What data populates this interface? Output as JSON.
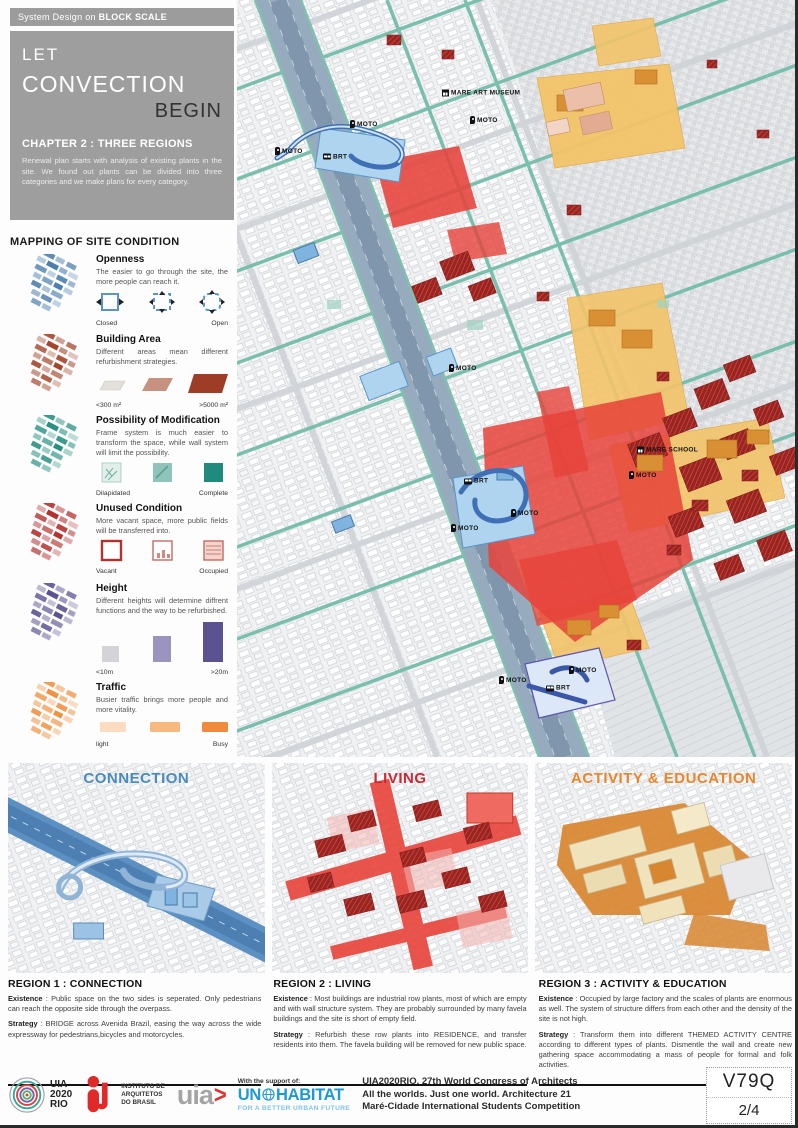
{
  "labels": {
    "separator": " : "
  },
  "header": {
    "kicker_normal": "System Design on",
    "kicker_bold": "BLOCK SCALE",
    "title_line1": "LET",
    "title_line2": "CONVECTION",
    "title_line3": "BEGIN",
    "chapter": "CHAPTER 2 : THREE REGIONS",
    "chapter_desc": "Renewal plan starts with analysis of existing plants in the site. We found out plants can be divided into three categories and we make plans for every category."
  },
  "legend": {
    "title": "MAPPING OF SITE CONDITION",
    "items": [
      {
        "name": "Openness",
        "desc": "The easier to go through the site, the more people can reach it.",
        "scale_left": "Closed",
        "scale_right": "Open",
        "color": "#4d7fae"
      },
      {
        "name": "Building Area",
        "desc": "Different areas mean different refurbishment strategies.",
        "scale_left": "<300 m²",
        "scale_right": ">5000 m²",
        "color": "#a3462c"
      },
      {
        "name": "Possibility of Modification",
        "desc": "Frame system is much easier to transform the space, while wall system will limit the possibility.",
        "scale_left": "Dilapidated",
        "scale_right": "Complete",
        "color": "#279183"
      },
      {
        "name": "Unused Condition",
        "desc": "More vacant space, more public fields will be transferred into.",
        "scale_left": "Vacant",
        "scale_right": "Occupied",
        "color": "#b23230"
      },
      {
        "name": "Height",
        "desc": "Different heights will determine diffrent functions and the way to be refurbished.",
        "scale_left": "<10m",
        "scale_right": ">20m",
        "color": "#5b5391"
      },
      {
        "name": "Traffic",
        "desc": "Busier traffic brings more people and more vitality.",
        "scale_left": "light",
        "scale_right": "Busy",
        "color": "#ef9242"
      }
    ]
  },
  "map": {
    "labels": [
      {
        "text": "MARE ART MUSEUM",
        "icon": "museum",
        "x": 205,
        "y": 93
      },
      {
        "text": "MOTO",
        "icon": "pin",
        "x": 233,
        "y": 120
      },
      {
        "text": "MOTO",
        "icon": "pin",
        "x": 113,
        "y": 124
      },
      {
        "text": "MOTO",
        "icon": "pin",
        "x": 38,
        "y": 151
      },
      {
        "text": "BRT",
        "icon": "bus",
        "x": 86,
        "y": 157
      },
      {
        "text": "MOTO",
        "icon": "pin",
        "x": 212,
        "y": 368
      },
      {
        "text": "MARE SCHOOL",
        "icon": "school",
        "x": 400,
        "y": 450
      },
      {
        "text": "MOTO",
        "icon": "pin",
        "x": 392,
        "y": 475
      },
      {
        "text": "BRT",
        "icon": "bus",
        "x": 227,
        "y": 481
      },
      {
        "text": "MOTO",
        "icon": "pin",
        "x": 274,
        "y": 513
      },
      {
        "text": "MOTO",
        "icon": "pin",
        "x": 214,
        "y": 528
      },
      {
        "text": "MOTO",
        "icon": "pin",
        "x": 332,
        "y": 670
      },
      {
        "text": "MOTO",
        "icon": "pin",
        "x": 262,
        "y": 680
      },
      {
        "text": "BRT",
        "icon": "bus",
        "x": 309,
        "y": 688
      }
    ]
  },
  "panels": [
    {
      "title": "CONNECTION",
      "accent": "#4a8bbf",
      "heading": "REGION 1 : CONNECTION",
      "existence_label": "Existence",
      "existence": "Public space on the two sides is seperated. Only pedestrians can reach the opposite side through the overpass.",
      "strategy_label": "Strategy",
      "strategy": "BRIDGE across Avenida Brazil, easing the way across the wide expressway for pedestrians,bicycles and motorcycles."
    },
    {
      "title": "LIVING",
      "accent": "#cc2a33",
      "heading": "REGION 2 : LIVING",
      "existence_label": "Existence",
      "existence": "Most buildings are industrial row plants, most of which are empty and with wall structure system. They are probably surrounded by many favela buildings and the site is short of empty field.",
      "strategy_label": "Strategy",
      "strategy": "Refurbish these row plants into RESIDENCE, and transfer residents into them. The favela building will be removed for new public space."
    },
    {
      "title": "ACTIVITY & EDUCATION",
      "accent": "#e8862e",
      "heading": "REGION 3 : ACTIVITY & EDUCATION",
      "existence_label": "Existence",
      "existence": "Occupied by large factory and the scales of plants are enormous as well. The system of structure differs from each other and the density of the site is not high.",
      "strategy_label": "Strategy",
      "strategy": "Transform them into different THEMED ACTIVITY CENTRE according to different types of plants. Dismentle the wall and create new gathering space accommodating a mass of people for formal and folk activities."
    }
  ],
  "footer": {
    "uia2020_lines": [
      "UIA",
      "2020",
      "RIO"
    ],
    "iab_lines": [
      "INSTITUTO DE",
      "ARQUITETOS",
      "DO BRASIL"
    ],
    "uia_wordmark": "uia",
    "uia_arrow": ">",
    "support": "With the support of:",
    "un_left": "UN",
    "un_right": "HABITAT",
    "un_tagline": "FOR A BETTER URBAN FUTURE",
    "congress_lines": [
      "UIA2020RIO. 27th World Congress of Architects",
      "All the worlds. Just one world. Architecture 21",
      "Maré-Cidade International Students Competition"
    ],
    "code": "V79Q",
    "page": "2/4"
  }
}
